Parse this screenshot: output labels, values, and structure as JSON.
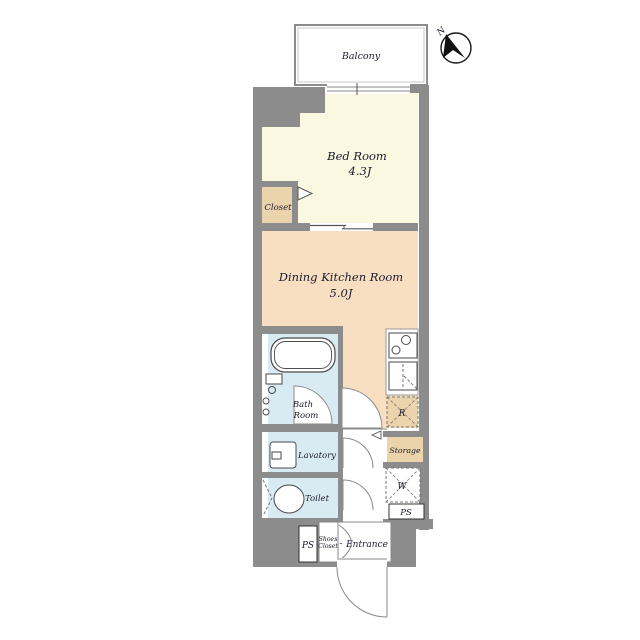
{
  "plan_title": "1K apartment floor plan",
  "compass": {
    "north_label": "N"
  },
  "balcony": {
    "label": "Balcony"
  },
  "rooms": {
    "bedroom": {
      "name": "Bed Room",
      "area": "4.3J"
    },
    "dining": {
      "name": "Dining Kitchen Room",
      "area": "5.0J"
    },
    "closet": {
      "label": "Closet"
    },
    "bath": {
      "line1": "Bath",
      "line2": "Room"
    },
    "lavatory": {
      "label": "Lavatory"
    },
    "toilet": {
      "label": "Toilet"
    },
    "storage": {
      "label": "Storage"
    },
    "refrigerator_space": {
      "label": "R"
    },
    "washer_space": {
      "label": "W"
    },
    "pipe_space_right": {
      "label": "PS"
    },
    "pipe_space_left": {
      "label": "PS"
    },
    "shoes_closet": {
      "line1": "Shoes",
      "line2": "Closet"
    },
    "entrance": {
      "label": "Entrance",
      "leader": "-"
    }
  },
  "colors": {
    "wall": "#8c8c8c",
    "bedroom_floor": "#faf8e0",
    "dining_floor": "#f8dfc1",
    "closet_tan": "#ebd3ab",
    "wet_room_blue": "#d8eaf2",
    "white": "#ffffff"
  }
}
